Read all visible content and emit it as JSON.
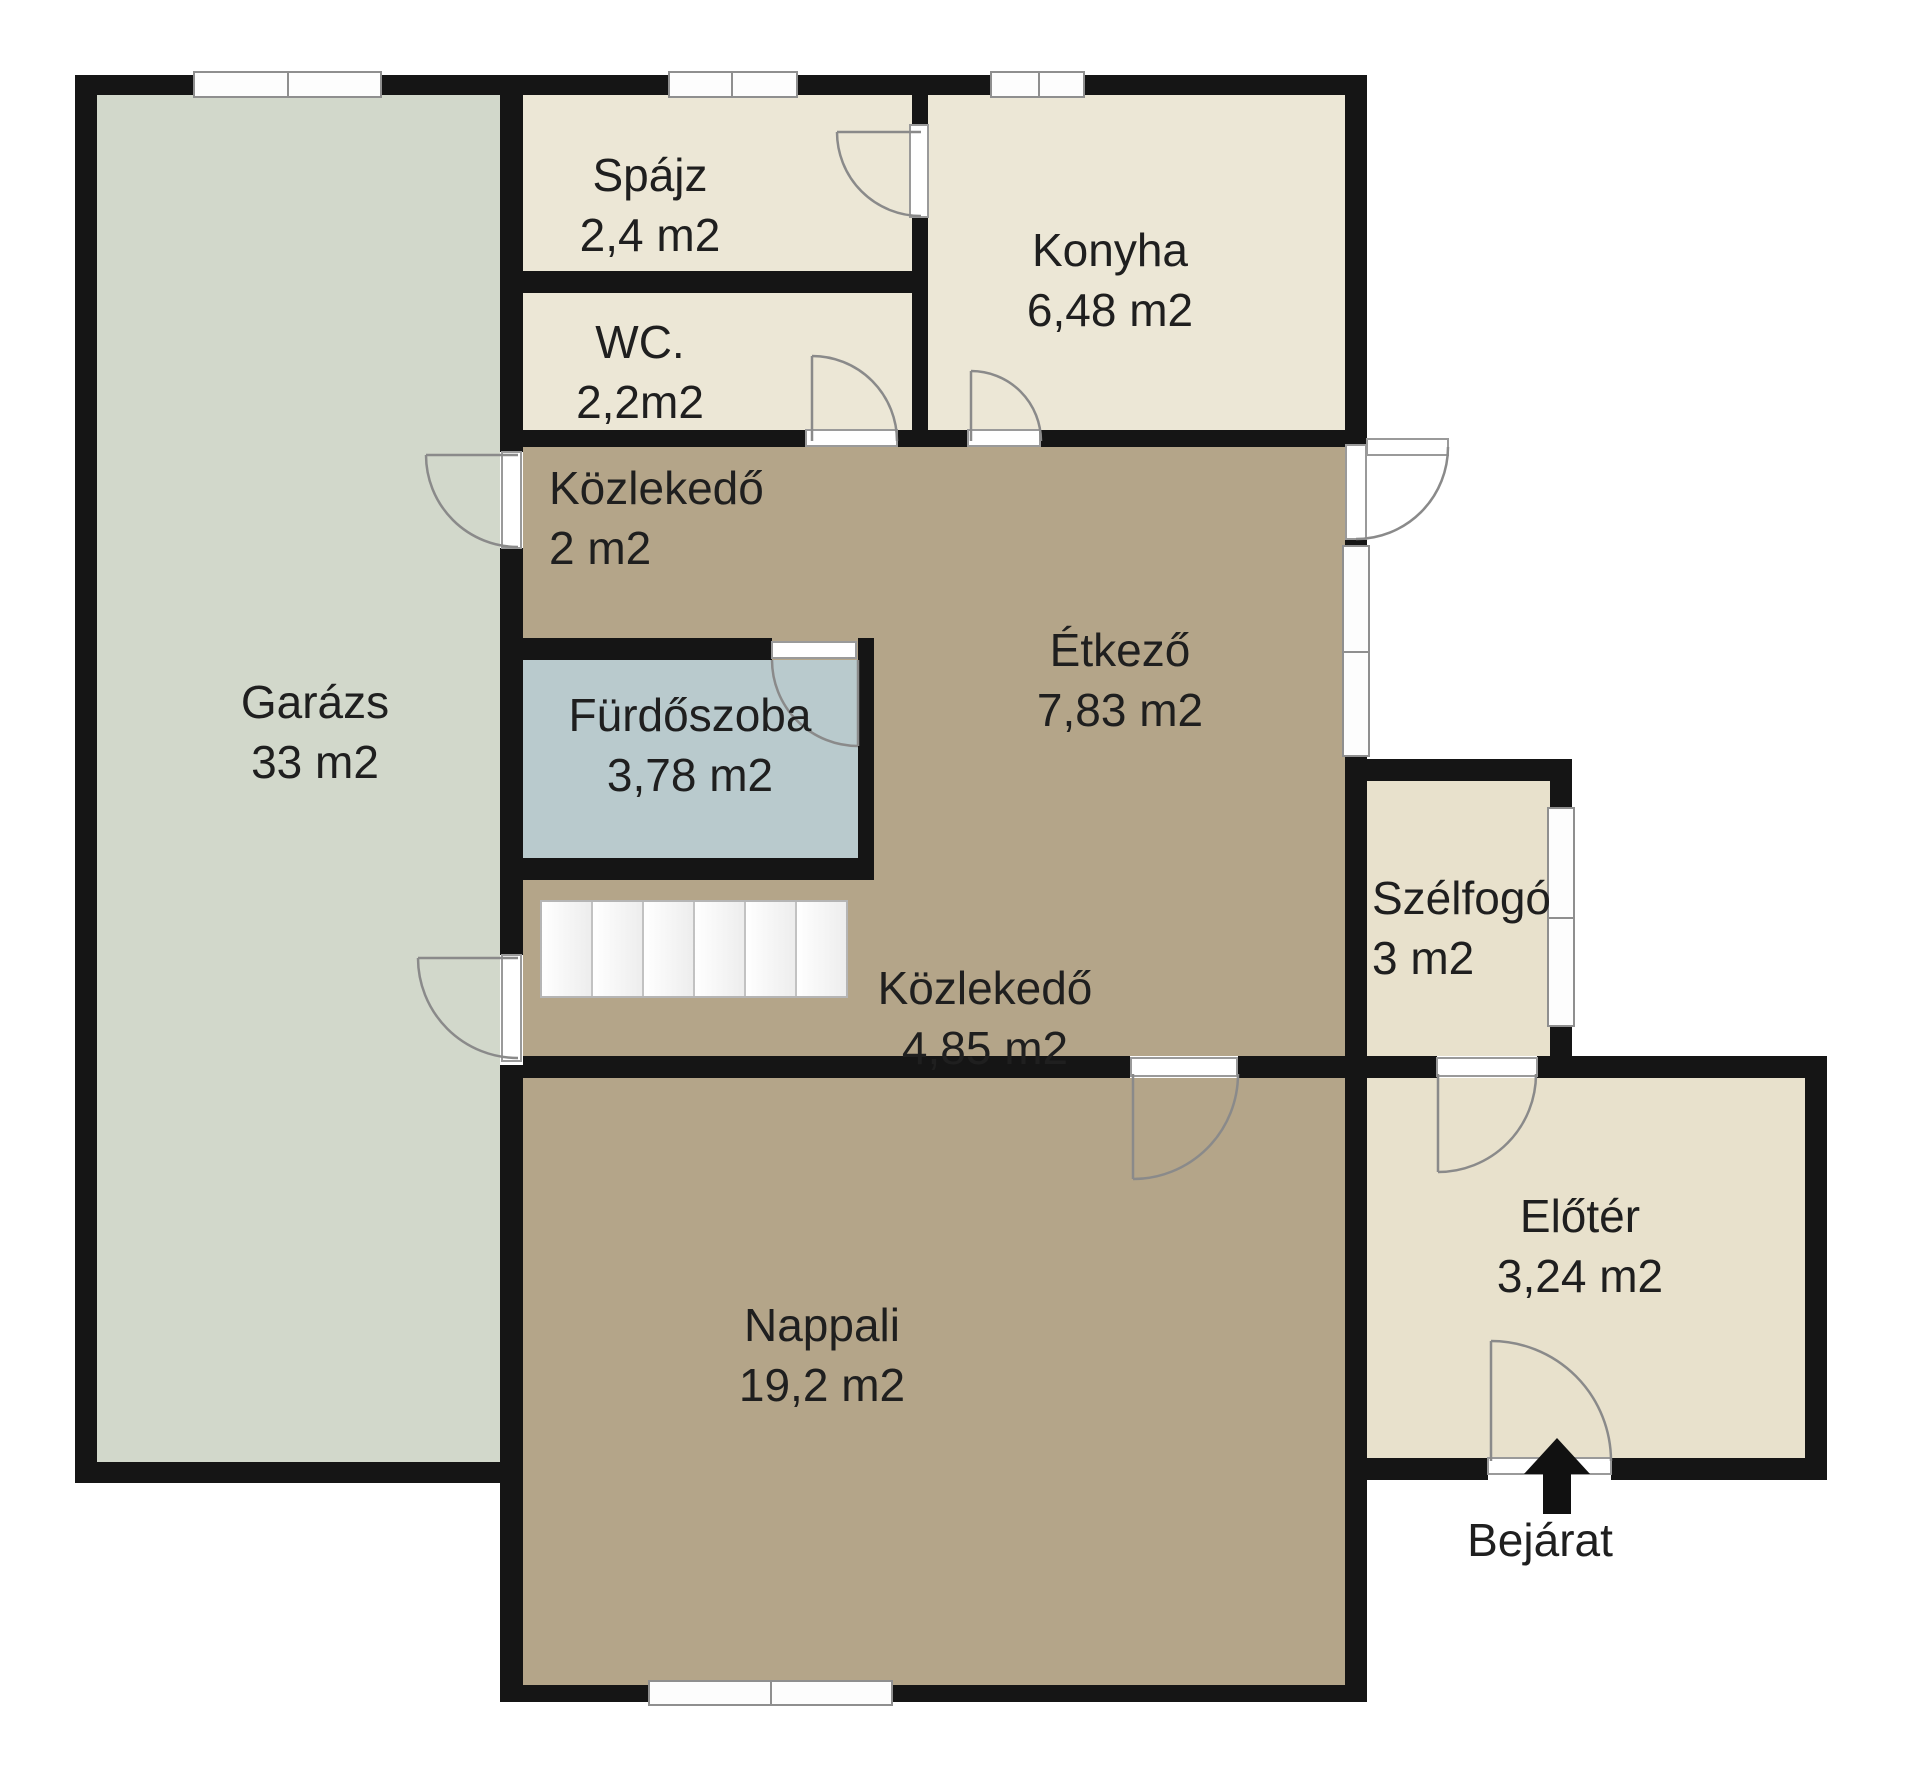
{
  "plan": {
    "rooms": {
      "garaz": {
        "name": "Garázs",
        "area": "33 m2"
      },
      "spajz": {
        "name": "Spájz",
        "area": "2,4 m2"
      },
      "wc": {
        "name": "WC.",
        "area": "2,2m2"
      },
      "konyha": {
        "name": "Konyha",
        "area": "6,48 m2"
      },
      "kozlekedo1": {
        "name": "Közlekedő",
        "area": "2 m2"
      },
      "furdoszoba": {
        "name": "Fürdőszoba",
        "area": "3,78 m2"
      },
      "etkezo": {
        "name": "Étkező",
        "area": "7,83 m2"
      },
      "kozlekedo2": {
        "name": "Közlekedő",
        "area": "4,85 m2"
      },
      "szelfogo": {
        "name": "Szélfogó",
        "area": "3 m2"
      },
      "nappali": {
        "name": "Nappali",
        "area": "19,2 m2"
      },
      "eloter": {
        "name": "Előtér",
        "area": "3,24 m2"
      }
    },
    "entrance_label": "Bejárat",
    "colors": {
      "wall": "#151515",
      "garage_floor": "#d2d8cb",
      "pantry_floor": "#ece7d6",
      "hall_floor": "#e8e1cc",
      "living_floor": "#b4a589",
      "bath_floor": "#b9cacd",
      "window_frame": "#8f8f8f",
      "door_arc": "#8a8a8a",
      "text": "#1f1f1f"
    }
  }
}
